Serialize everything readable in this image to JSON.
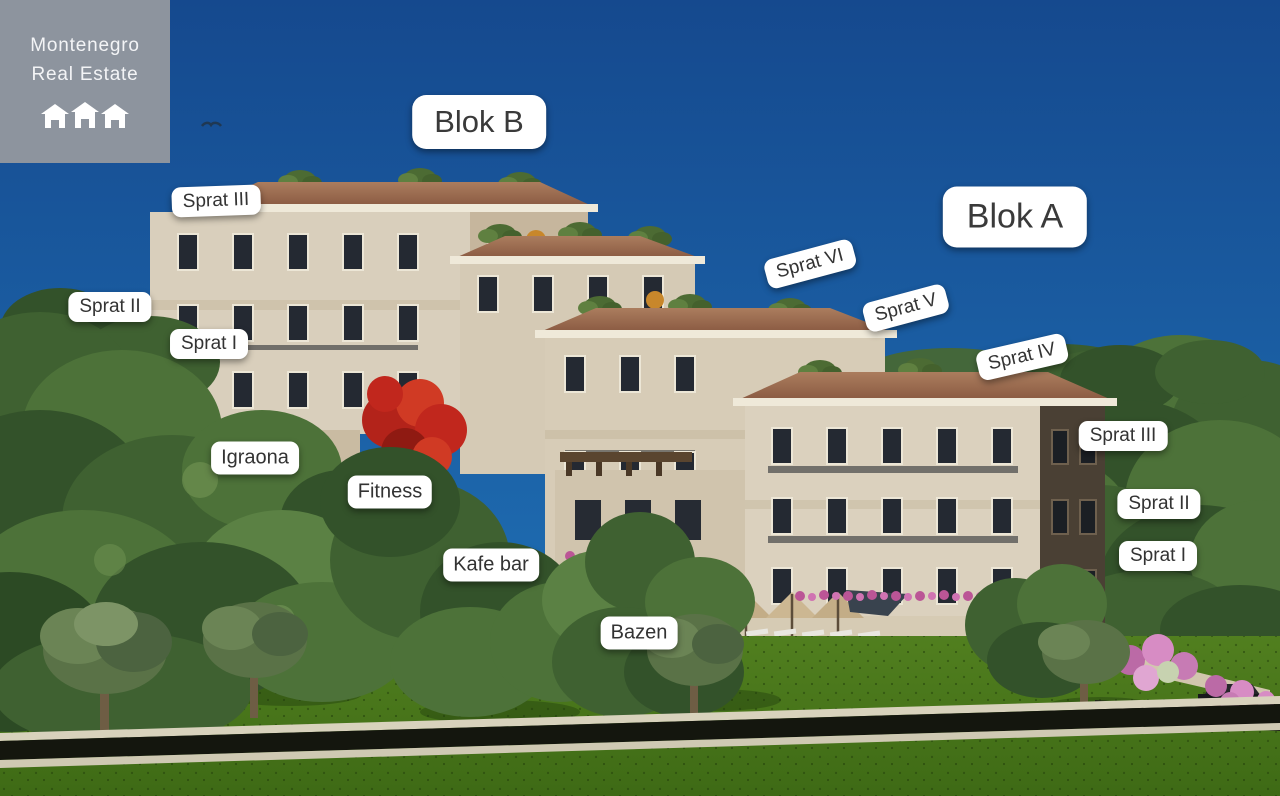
{
  "logo": {
    "line1": "Montenegro",
    "line2": "Real Estate",
    "icon": "three-houses-icon"
  },
  "blocks": {
    "blok_b": "Blok B",
    "blok_a": "Blok A"
  },
  "floors_left": {
    "sprat_3": "Sprat III",
    "sprat_2": "Sprat II",
    "sprat_1": "Sprat I"
  },
  "floors_mid": {
    "sprat_6": "Sprat VI",
    "sprat_5": "Sprat V",
    "sprat_4": "Sprat IV"
  },
  "floors_right": {
    "sprat_3": "Sprat III",
    "sprat_2": "Sprat II",
    "sprat_1": "Sprat I"
  },
  "amenities": {
    "igraona": "Igraona",
    "fitness": "Fitness",
    "kafe_bar": "Kafe bar",
    "bazen": "Bazen"
  },
  "colors": {
    "sky_top": "#15498e",
    "sky_bottom": "#1f6fb4",
    "label_bg": "#ffffff",
    "label_text": "#333333",
    "logo_bg": "#8d949e",
    "logo_text": "#f3f4f6",
    "building_wall": "#d9cfbc",
    "roof": "#a07254",
    "trees": "#3f6131",
    "grass": "#4a7a1e"
  }
}
